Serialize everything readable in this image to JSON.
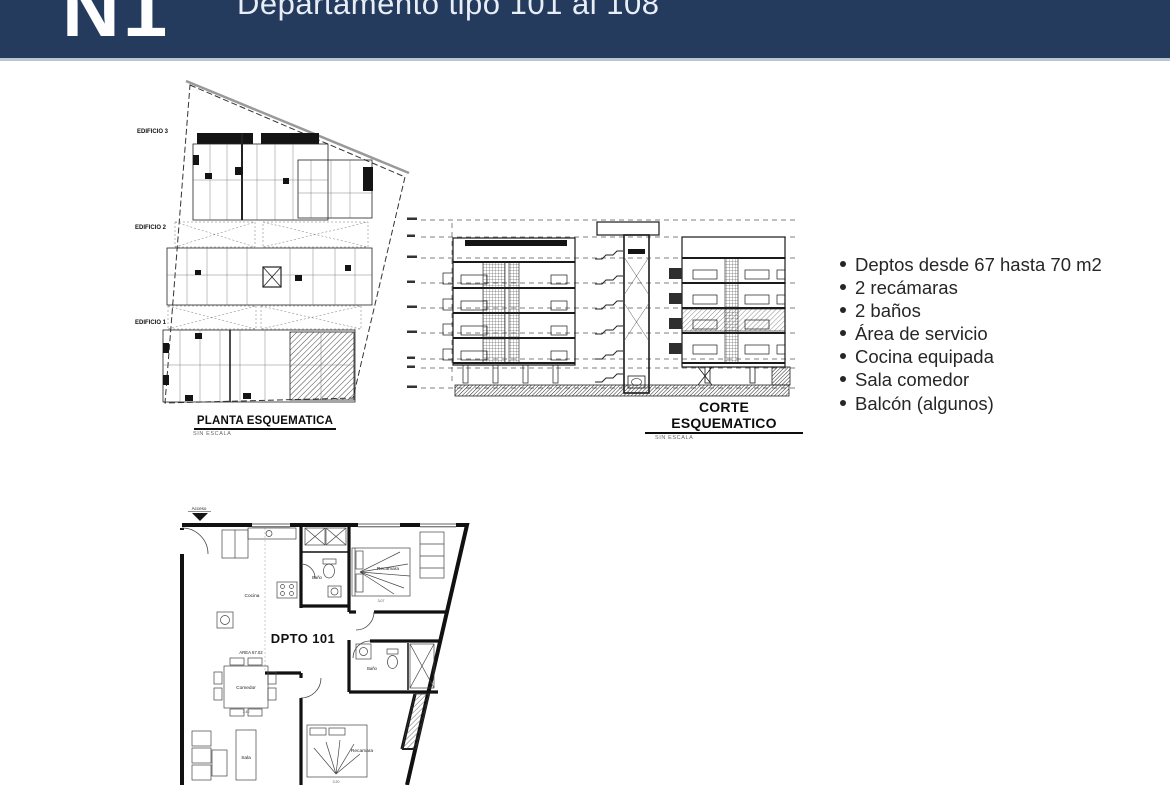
{
  "header": {
    "logo": "N1",
    "title": "Departamento tipo 101 al 108",
    "bg_color": "#243b5e",
    "divider_color": "#b9c6d4"
  },
  "planta": {
    "labels": {
      "edificio3": "EDIFICIO 3",
      "edificio2": "EDIFICIO 2",
      "edificio1": "EDIFICIO 1"
    },
    "caption": "PLANTA ESQUEMATICA",
    "caption_sub": "SIN ESCALA"
  },
  "corte": {
    "caption": "CORTE ESQUEMATICO",
    "caption_sub": "SIN ESCALA"
  },
  "features": {
    "items": [
      "Deptos desde 67 hasta 70 m2",
      "2  recámaras",
      "2 baños",
      "Área de servicio",
      "Cocina equipada",
      "Sala comedor",
      "Balcón (algunos)"
    ]
  },
  "floorplan": {
    "access_label": "Acceso",
    "unit_title": "DPTO 101",
    "unit_area": "AREA 67.02",
    "rooms": {
      "cocina": "Cocina",
      "bano1": "Baño",
      "recamara1": "Recamara",
      "comedor": "Comedor",
      "bano2": "Baño",
      "sala": "Sala",
      "recamara2": "Recamara"
    },
    "dims": {
      "recamara1": "3.07",
      "comedor": "3.40",
      "recamara2": "3.20"
    }
  }
}
